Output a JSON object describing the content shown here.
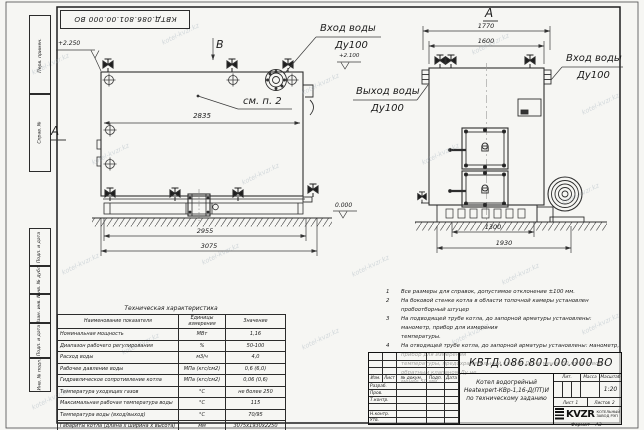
{
  "meta": {
    "watermark": "kotel-kvzr.kz"
  },
  "doc_number": "КВТД.086.801.00.000 ВО",
  "frame_labels": [
    "Перв. примен.",
    "Справ. №",
    "Подп. и дата",
    "Инв. № дубл.",
    "Взам. инв. №",
    "Подп. и дата",
    "Инв. № подл."
  ],
  "drawing": {
    "view_b": "В",
    "section_a": "А",
    "view_a": "А",
    "callout_see_p2": "см. п. 2",
    "elev_2250": "+2.250",
    "elev_2100": "+2.100",
    "elev_0": "0.000",
    "dim_2835": "2835",
    "dim_2955": "2955",
    "dim_3075": "3075",
    "dim_1770": "1770",
    "dim_1600": "1600",
    "dim_1300": "1300",
    "dim_1930": "1930",
    "label_inlet_1": "Вход воды",
    "label_inlet_1_dn": "Ду100",
    "label_outlet": "Выход воды",
    "label_outlet_dn": "Ду100",
    "label_inlet_2": "Вход воды",
    "label_inlet_2_dn": "Ду100"
  },
  "notes": {
    "items": [
      {
        "num": "1",
        "lines": [
          "Все размеры для справок, допустимое отклонение ±100 мм."
        ]
      },
      {
        "num": "2",
        "lines": [
          "На боковой стенке котла в области топочной камеры установлен пробоотборный штуцер"
        ]
      },
      {
        "num": "3",
        "lines": [
          "На подводящей трубе котла, до запорной арматуры установлены: манометр, прибор для измерения",
          "температуры."
        ]
      },
      {
        "num": "4",
        "lines": [
          "На отводящей трубе котла, до запорной арматуры установлены: манометр, прибор для измерения",
          "температуры, предохранительный клапан Ду не менее 50 мм и отвод с обратным клапаном Ду не",
          "менее 50 мм."
        ]
      }
    ]
  },
  "spec_table": {
    "title": "Техническая характеристика",
    "headers": [
      "Наименование показателя",
      "Единицы измерения",
      "Значение"
    ],
    "rows": [
      [
        "Номинальная мощность",
        "МВт",
        "1,16"
      ],
      [
        "Диапазон рабочего регулирования",
        "%",
        "50-100"
      ],
      [
        "Расход воды",
        "м3/ч",
        "4,0"
      ],
      [
        "Рабочее давление воды",
        "МПа (кгс/см2)",
        "0,6 (6,0)"
      ],
      [
        "Гидравлическое сопротивление котла",
        "МПа (кгс/см2)",
        "0,06 (0,6)"
      ],
      [
        "Температура уходящих газов",
        "°С",
        "не более 250"
      ],
      [
        "Максимальная рабочая температура воды",
        "°С",
        "115"
      ],
      [
        "Температура воды (вход/выход)",
        "°С",
        "70/95"
      ],
      [
        "Габариты котла (длина х ширина х высота)",
        "мм",
        "3075х1930х2250"
      ]
    ]
  },
  "title_block": {
    "header_cols": [
      "Изм.",
      "Лист",
      "№ докум.",
      "Подп.",
      "Дата"
    ],
    "rows": [
      "Разраб.",
      "Пров.",
      "Т.контр.",
      "",
      "Н.контр.",
      "Утв."
    ],
    "name_line1": "Котел водогрейный",
    "name_line2": "Heatexpert-КВр-1,16-Д(ПТ)И",
    "name_line3": "по техническому заданию",
    "lit_label": "Лит.",
    "mass_label": "Масса",
    "scale_label": "Масштаб",
    "scale_value": "1:20",
    "sheet_label": "Лист",
    "sheet_value": "1",
    "sheets_label": "Листов",
    "sheets_value": "2",
    "logo_text": "KVZR",
    "logo_sub1": "КОТЕЛЬНЫЙ",
    "logo_sub2": "ЗАВОД РЭП",
    "format_label": "Формат",
    "format_value": "А3"
  }
}
